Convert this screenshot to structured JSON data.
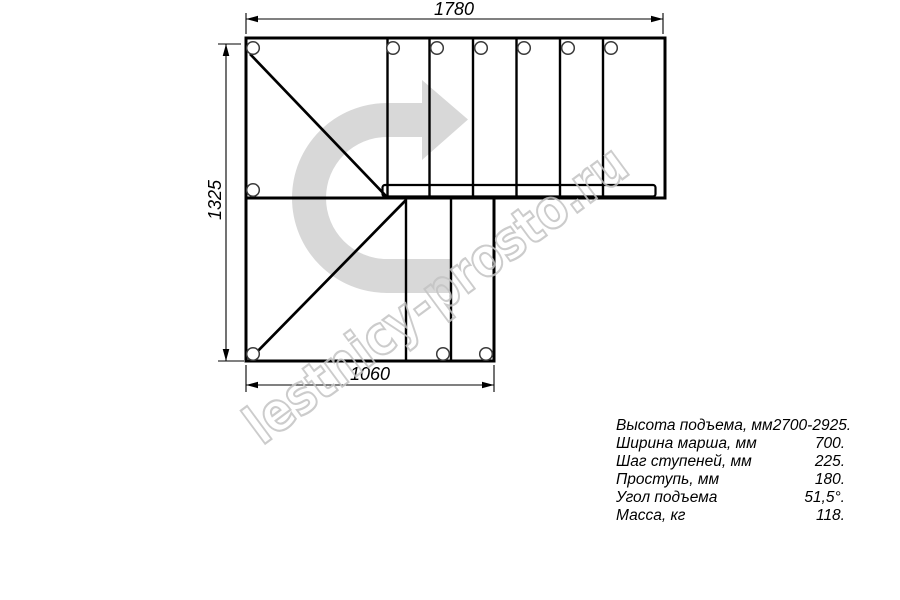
{
  "drawing": {
    "type": "staircase-plan-top-view",
    "upper_flight_steps": 6,
    "lower_flight_steps": 2,
    "turn": "180-degree turn indicated by gray arrow"
  },
  "dimensions": {
    "top": "1780",
    "left": "1325",
    "bottom": "1060"
  },
  "watermark": {
    "text": "lestnicy-prosto.ru"
  },
  "colors": {
    "arrow_fill": "#d8d8d8",
    "watermark_outline": "#c4c4c4",
    "line": "#000000"
  },
  "specs": {
    "rows": [
      {
        "label": "Высота подъема, мм",
        "value": "2700-2925."
      },
      {
        "label": "Ширина марша, мм",
        "value": "700."
      },
      {
        "label": "Шаг ступеней, мм",
        "value": "225."
      },
      {
        "label": "Проступь, мм",
        "value": "180."
      },
      {
        "label": "Угол подъема",
        "value": "51,5°."
      },
      {
        "label": "Масса, кг",
        "value": "118."
      }
    ]
  }
}
